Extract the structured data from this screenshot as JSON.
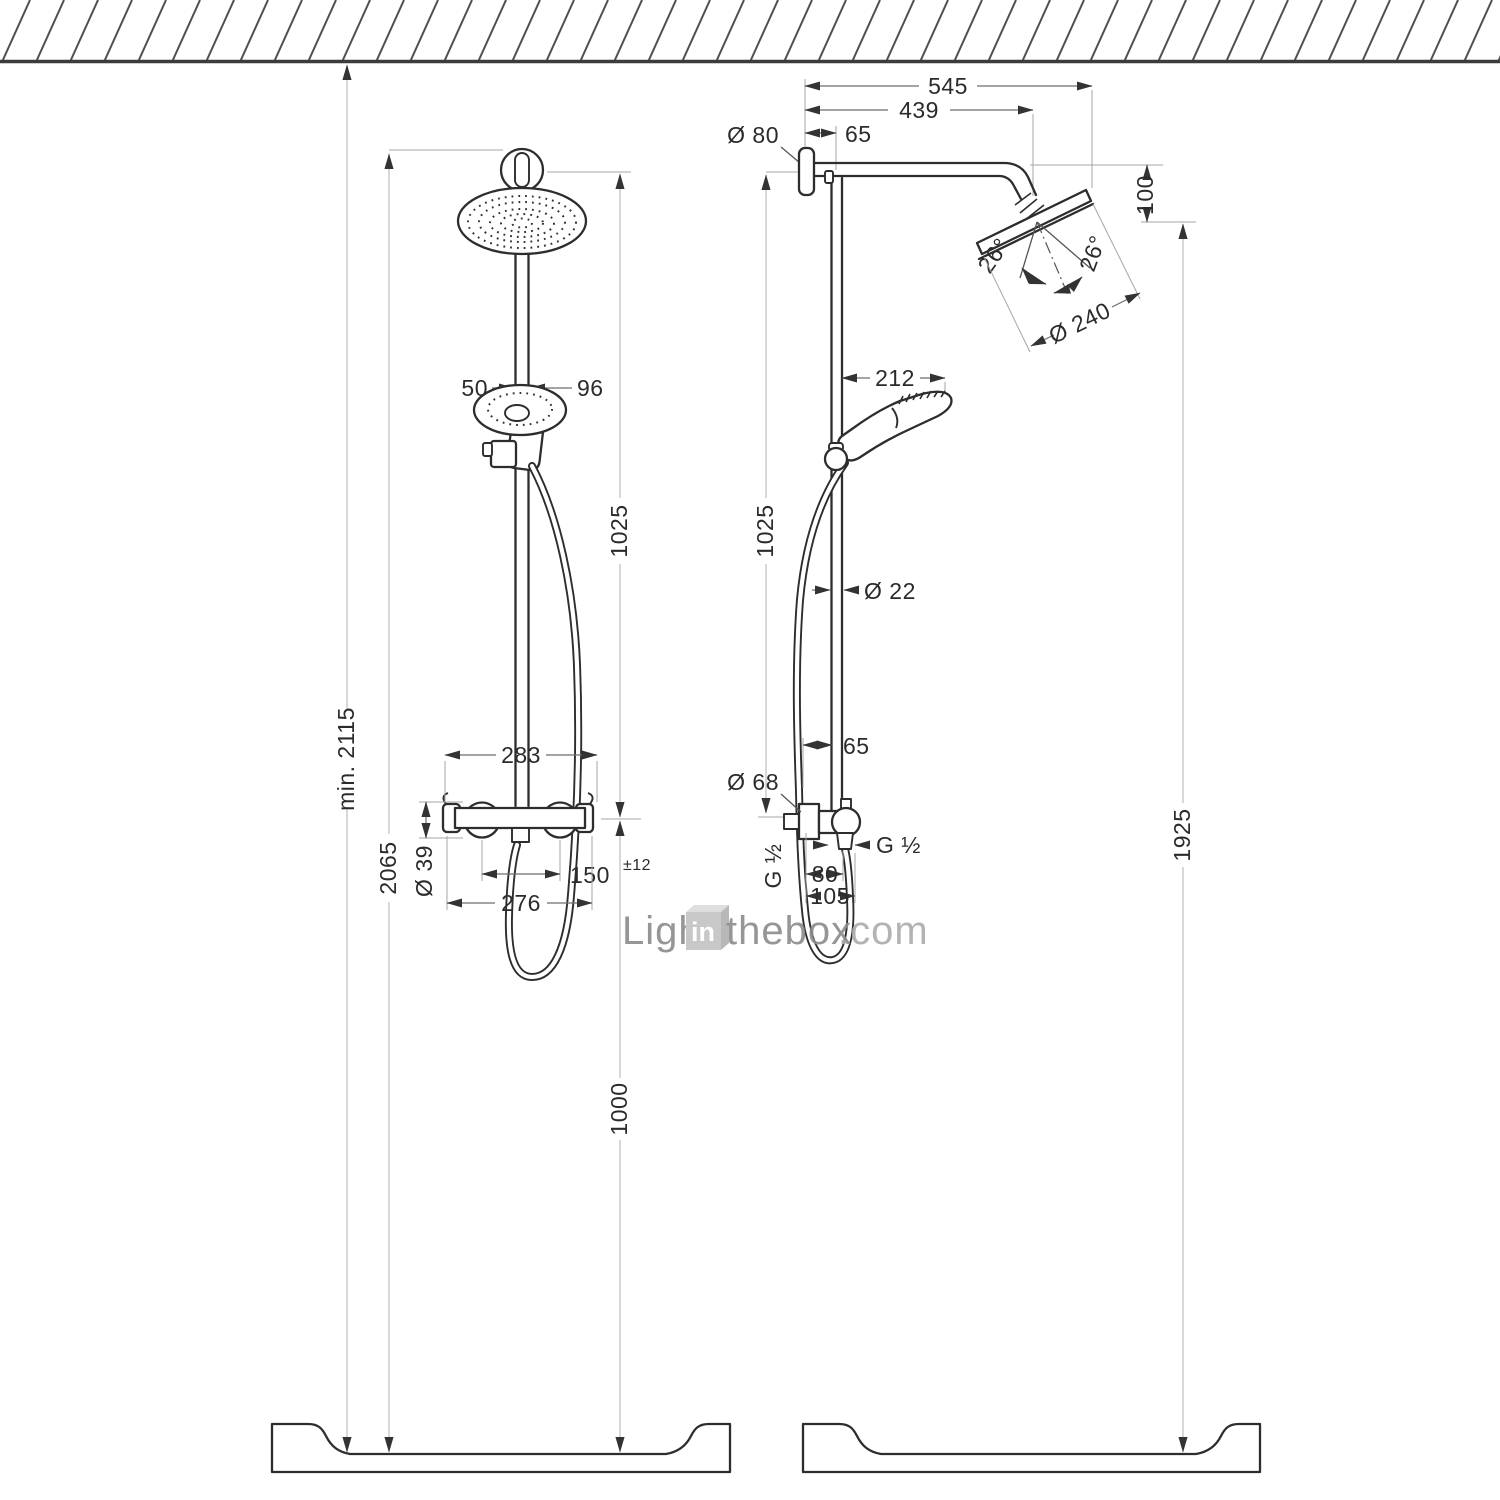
{
  "front": {
    "min_height": "min. 2115",
    "h2065": "2065",
    "h1025": "1025",
    "h1000": "1000",
    "w50": "50",
    "w96": "96",
    "w283": "283",
    "dia39": "Ø 39",
    "w150": "150",
    "tol": "±12",
    "w276": "276"
  },
  "side": {
    "w545": "545",
    "w439": "439",
    "w65_top": "65",
    "dia80": "Ø 80",
    "h100": "100",
    "angle_left": "26°",
    "angle_right": "26°",
    "dia240": "Ø 240",
    "w212": "212",
    "dia22": "Ø 22",
    "h1025": "1025",
    "w65_mid": "65",
    "dia68": "Ø 68",
    "g_left": "G ½",
    "g_right": "G ½",
    "w80": "80",
    "w105": "105",
    "h1925": "1925"
  },
  "watermark": {
    "light": "Light",
    "in_box": "in",
    "thebox": "thebox",
    "com": ".com"
  },
  "colors": {
    "line": "#2d2d2d",
    "dim": "#6e6e6e",
    "chain_dim": "#bdbdbd",
    "extension": "#a6a6a6",
    "hatch": "#4f4f4f",
    "text": "#2b2b2b",
    "watermark": "#8b8b8b",
    "watermark_box": "#c8c8c8"
  }
}
